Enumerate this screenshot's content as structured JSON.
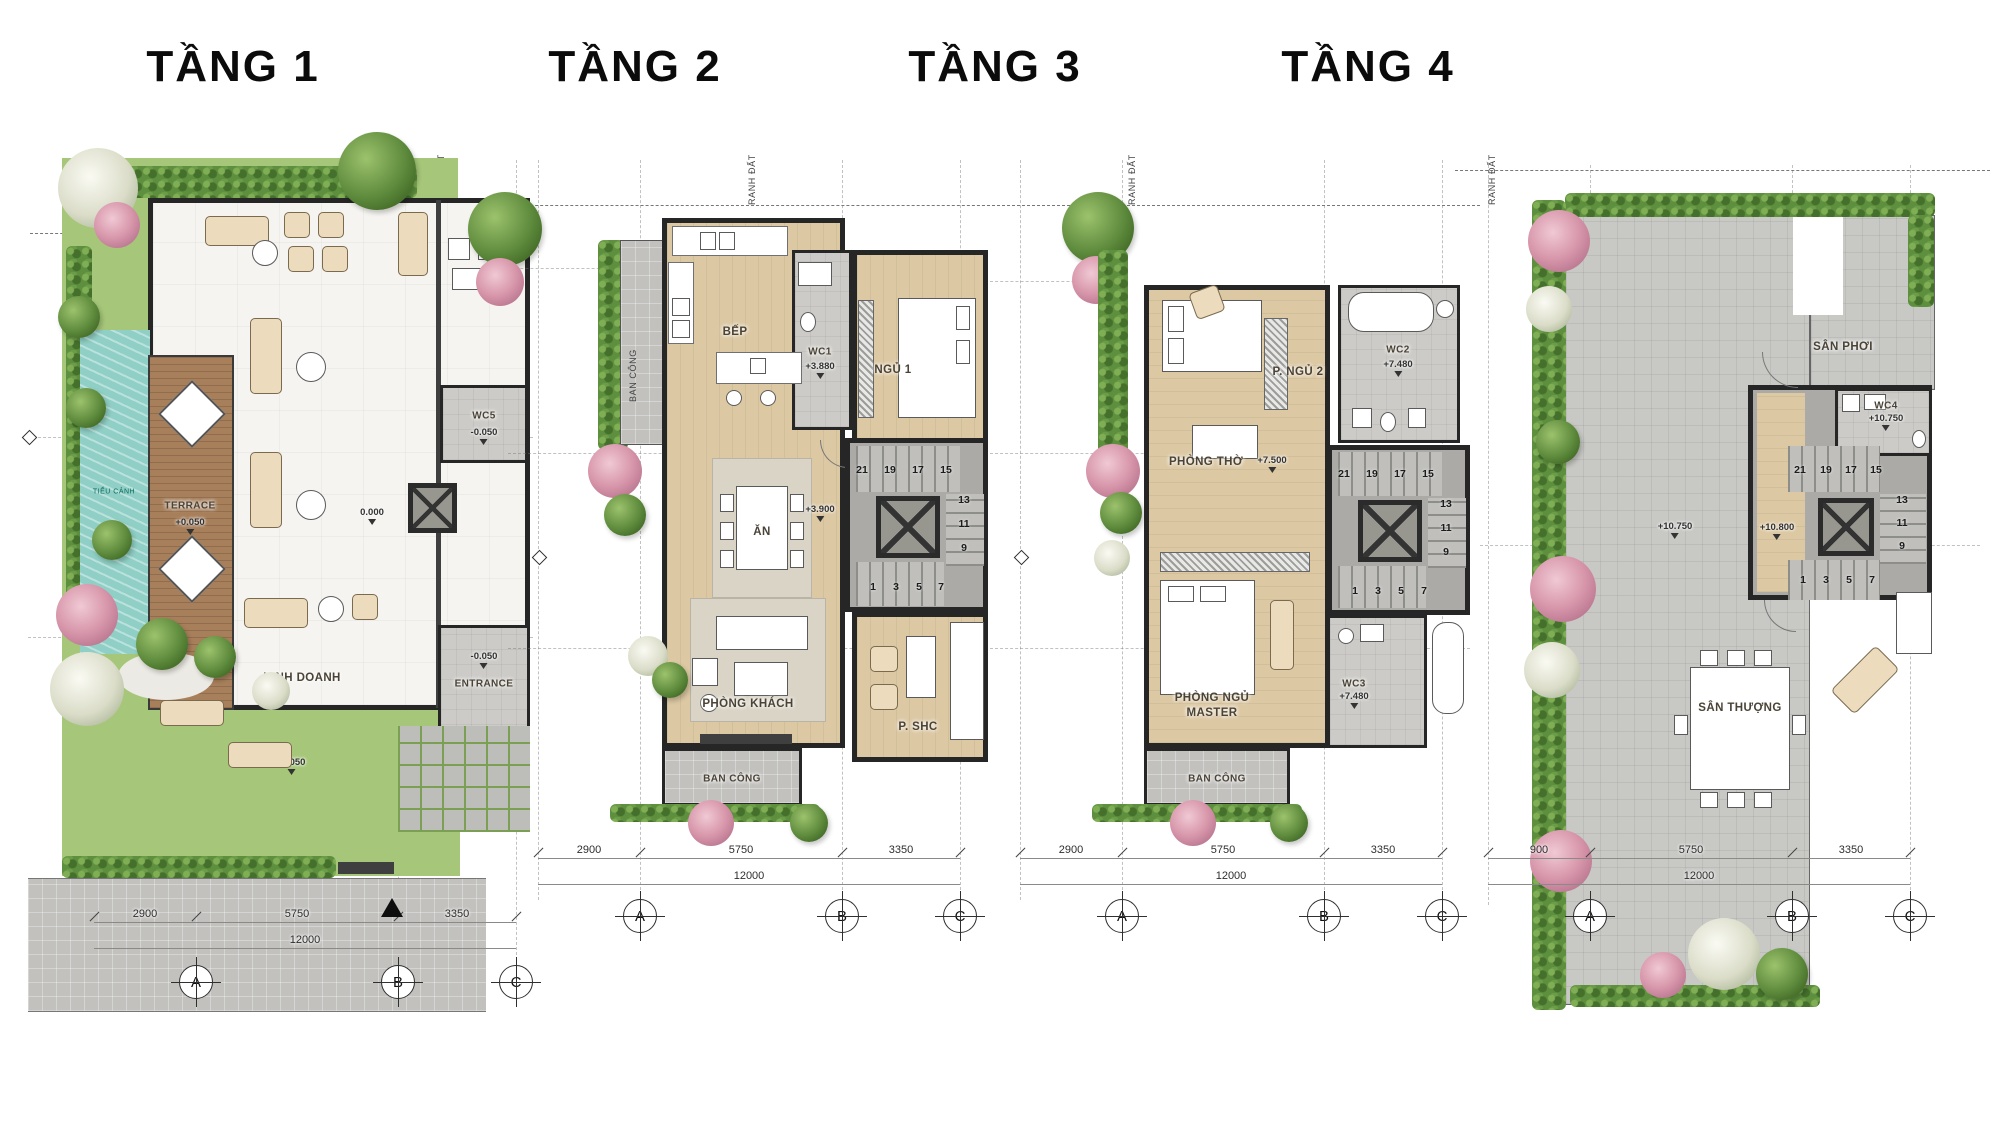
{
  "floors": [
    {
      "title": "TẦNG 1",
      "boundary": "RANH ĐẤT",
      "rooms": {
        "tieu_canh": "TIỂU CẢNH",
        "terrace": "TERRACE",
        "terrace_elev": "+0.050",
        "kinh_doanh": "KINH DOANH",
        "zero_elev": "0.000",
        "wc5": "WC5",
        "wc5_elev": "-0.050",
        "entrance": "ENTRANCE",
        "entrance_elev": "-0.050",
        "path_elev": "-0.050"
      },
      "dims": [
        "2900",
        "5750",
        "3350"
      ],
      "total_dim": "12000",
      "grid": [
        "A",
        "B",
        "C"
      ]
    },
    {
      "title": "TẦNG 2",
      "boundary": "RANH ĐẤT",
      "rooms": {
        "ban_cong_side": "BAN CÔNG",
        "bep": "BẾP",
        "wc1": "WC1",
        "wc1_elev": "+3.880",
        "ngu1": "NGỦ 1",
        "an": "ĂN",
        "hall_elev": "+3.900",
        "phong_khach": "PHÒNG KHÁCH",
        "p_shc": "P. SHC",
        "ban_cong": "BAN CÔNG"
      },
      "dims": [
        "2900",
        "5750",
        "3350"
      ],
      "total_dim": "12000",
      "grid": [
        "A",
        "B",
        "C"
      ]
    },
    {
      "title": "TẦNG 3",
      "boundary": "RANH ĐẤT",
      "rooms": {
        "p_ngu2": "P. NGỦ 2",
        "wc2": "WC2",
        "wc2_elev": "+7.480",
        "phong_tho": "PHÒNG THỜ",
        "phong_tho_elev": "+7.500",
        "master_1": "PHÒNG NGỦ",
        "master_2": "MASTER",
        "wc3": "WC3",
        "wc3_elev": "+7.480",
        "ban_cong": "BAN CÔNG"
      },
      "dims": [
        "2900",
        "5750",
        "3350"
      ],
      "total_dim": "12000",
      "grid": [
        "A",
        "B",
        "C"
      ]
    },
    {
      "title": "TẦNG 4",
      "boundary": "RANH ĐẤT",
      "rooms": {
        "san_phoi": "SÂN PHƠI",
        "wc4": "WC4",
        "wc4_elev": "+10.750",
        "terrace_elev": "+10.750",
        "hall_elev": "+10.800",
        "san_thuong": "SÂN THƯỢNG"
      },
      "dims": [
        "900",
        "5750",
        "3350"
      ],
      "total_dim": "12000",
      "grid": [
        "A",
        "B",
        "C"
      ]
    }
  ],
  "stairs": {
    "top": [
      "21",
      "19",
      "17",
      "15"
    ],
    "right": [
      "13",
      "11",
      "9"
    ],
    "bottom": [
      "1",
      "3",
      "5",
      "7"
    ]
  }
}
